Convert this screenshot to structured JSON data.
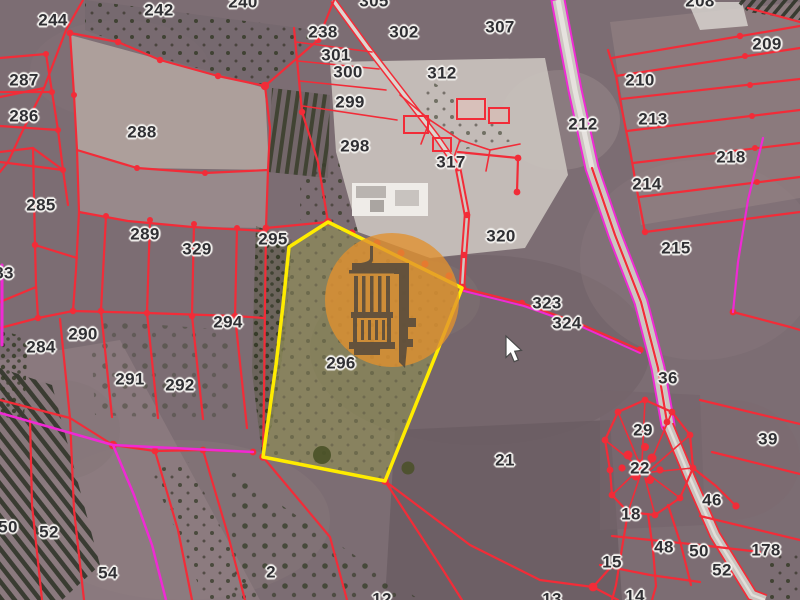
{
  "window": {
    "width": 800,
    "height": 600,
    "view": "cadastral parcel overlay on satellite imagery"
  },
  "map": {
    "highlighted_parcel": {
      "number": "296",
      "outline_color": "#ffec00",
      "fill_color": "#8f9052"
    },
    "watermark": {
      "icon": "pillory-tower-logo",
      "circle_color": "#e1912e",
      "icon_color": "#4d463d"
    },
    "cursor": {
      "x": 506,
      "y": 336
    },
    "colors": {
      "boundary_red": "#f22c38",
      "road_pink": "#ef2ad4",
      "highlight_yellow": "#ffec00",
      "highlight_fill_olive": "#8f9052",
      "label_text": "#2f2f33",
      "label_halo": "#f3f1ee"
    },
    "labels": [
      {
        "text": "244",
        "x": 53,
        "y": 20
      },
      {
        "text": "242",
        "x": 159,
        "y": 10
      },
      {
        "text": "240",
        "x": 243,
        "y": 2
      },
      {
        "text": "287",
        "x": 24,
        "y": 80
      },
      {
        "text": "286",
        "x": 24,
        "y": 116
      },
      {
        "text": "288",
        "x": 142,
        "y": 132
      },
      {
        "text": "285",
        "x": 41,
        "y": 205
      },
      {
        "text": "289",
        "x": 145,
        "y": 234
      },
      {
        "text": "329",
        "x": 197,
        "y": 249
      },
      {
        "text": "295",
        "x": 273,
        "y": 239
      },
      {
        "text": "83",
        "x": 4,
        "y": 273
      },
      {
        "text": "290",
        "x": 83,
        "y": 334
      },
      {
        "text": "284",
        "x": 41,
        "y": 347
      },
      {
        "text": "294",
        "x": 228,
        "y": 322
      },
      {
        "text": "291",
        "x": 130,
        "y": 379
      },
      {
        "text": "292",
        "x": 180,
        "y": 385
      },
      {
        "text": "238",
        "x": 323,
        "y": 32
      },
      {
        "text": "301",
        "x": 336,
        "y": 55
      },
      {
        "text": "300",
        "x": 348,
        "y": 72
      },
      {
        "text": "299",
        "x": 350,
        "y": 102
      },
      {
        "text": "298",
        "x": 355,
        "y": 146
      },
      {
        "text": "302",
        "x": 404,
        "y": 32
      },
      {
        "text": "305",
        "x": 374,
        "y": 1
      },
      {
        "text": "312",
        "x": 442,
        "y": 73
      },
      {
        "text": "307",
        "x": 500,
        "y": 27
      },
      {
        "text": "317",
        "x": 451,
        "y": 162
      },
      {
        "text": "320",
        "x": 501,
        "y": 236
      },
      {
        "text": "296",
        "x": 341,
        "y": 363
      },
      {
        "text": "323",
        "x": 547,
        "y": 303
      },
      {
        "text": "324",
        "x": 567,
        "y": 323
      },
      {
        "text": "208",
        "x": 700,
        "y": 1
      },
      {
        "text": "209",
        "x": 767,
        "y": 44
      },
      {
        "text": "210",
        "x": 640,
        "y": 80
      },
      {
        "text": "213",
        "x": 653,
        "y": 119
      },
      {
        "text": "218",
        "x": 731,
        "y": 157
      },
      {
        "text": "212",
        "x": 583,
        "y": 124
      },
      {
        "text": "214",
        "x": 647,
        "y": 184
      },
      {
        "text": "215",
        "x": 676,
        "y": 248
      },
      {
        "text": "36",
        "x": 668,
        "y": 378
      },
      {
        "text": "29",
        "x": 643,
        "y": 430
      },
      {
        "text": "39",
        "x": 768,
        "y": 439
      },
      {
        "text": "22",
        "x": 640,
        "y": 468
      },
      {
        "text": "46",
        "x": 712,
        "y": 500
      },
      {
        "text": "18",
        "x": 631,
        "y": 514
      },
      {
        "text": "48",
        "x": 664,
        "y": 547
      },
      {
        "text": "50",
        "x": 699,
        "y": 551
      },
      {
        "text": "178",
        "x": 766,
        "y": 550
      },
      {
        "text": "15",
        "x": 612,
        "y": 562
      },
      {
        "text": "52",
        "x": 722,
        "y": 570
      },
      {
        "text": "14",
        "x": 635,
        "y": 596
      },
      {
        "text": "50",
        "x": 8,
        "y": 527
      },
      {
        "text": "52",
        "x": 49,
        "y": 532
      },
      {
        "text": "54",
        "x": 108,
        "y": 573
      },
      {
        "text": "2",
        "x": 271,
        "y": 572
      },
      {
        "text": "21",
        "x": 505,
        "y": 460
      },
      {
        "text": "12",
        "x": 382,
        "y": 599
      },
      {
        "text": "13",
        "x": 552,
        "y": 599
      }
    ]
  }
}
